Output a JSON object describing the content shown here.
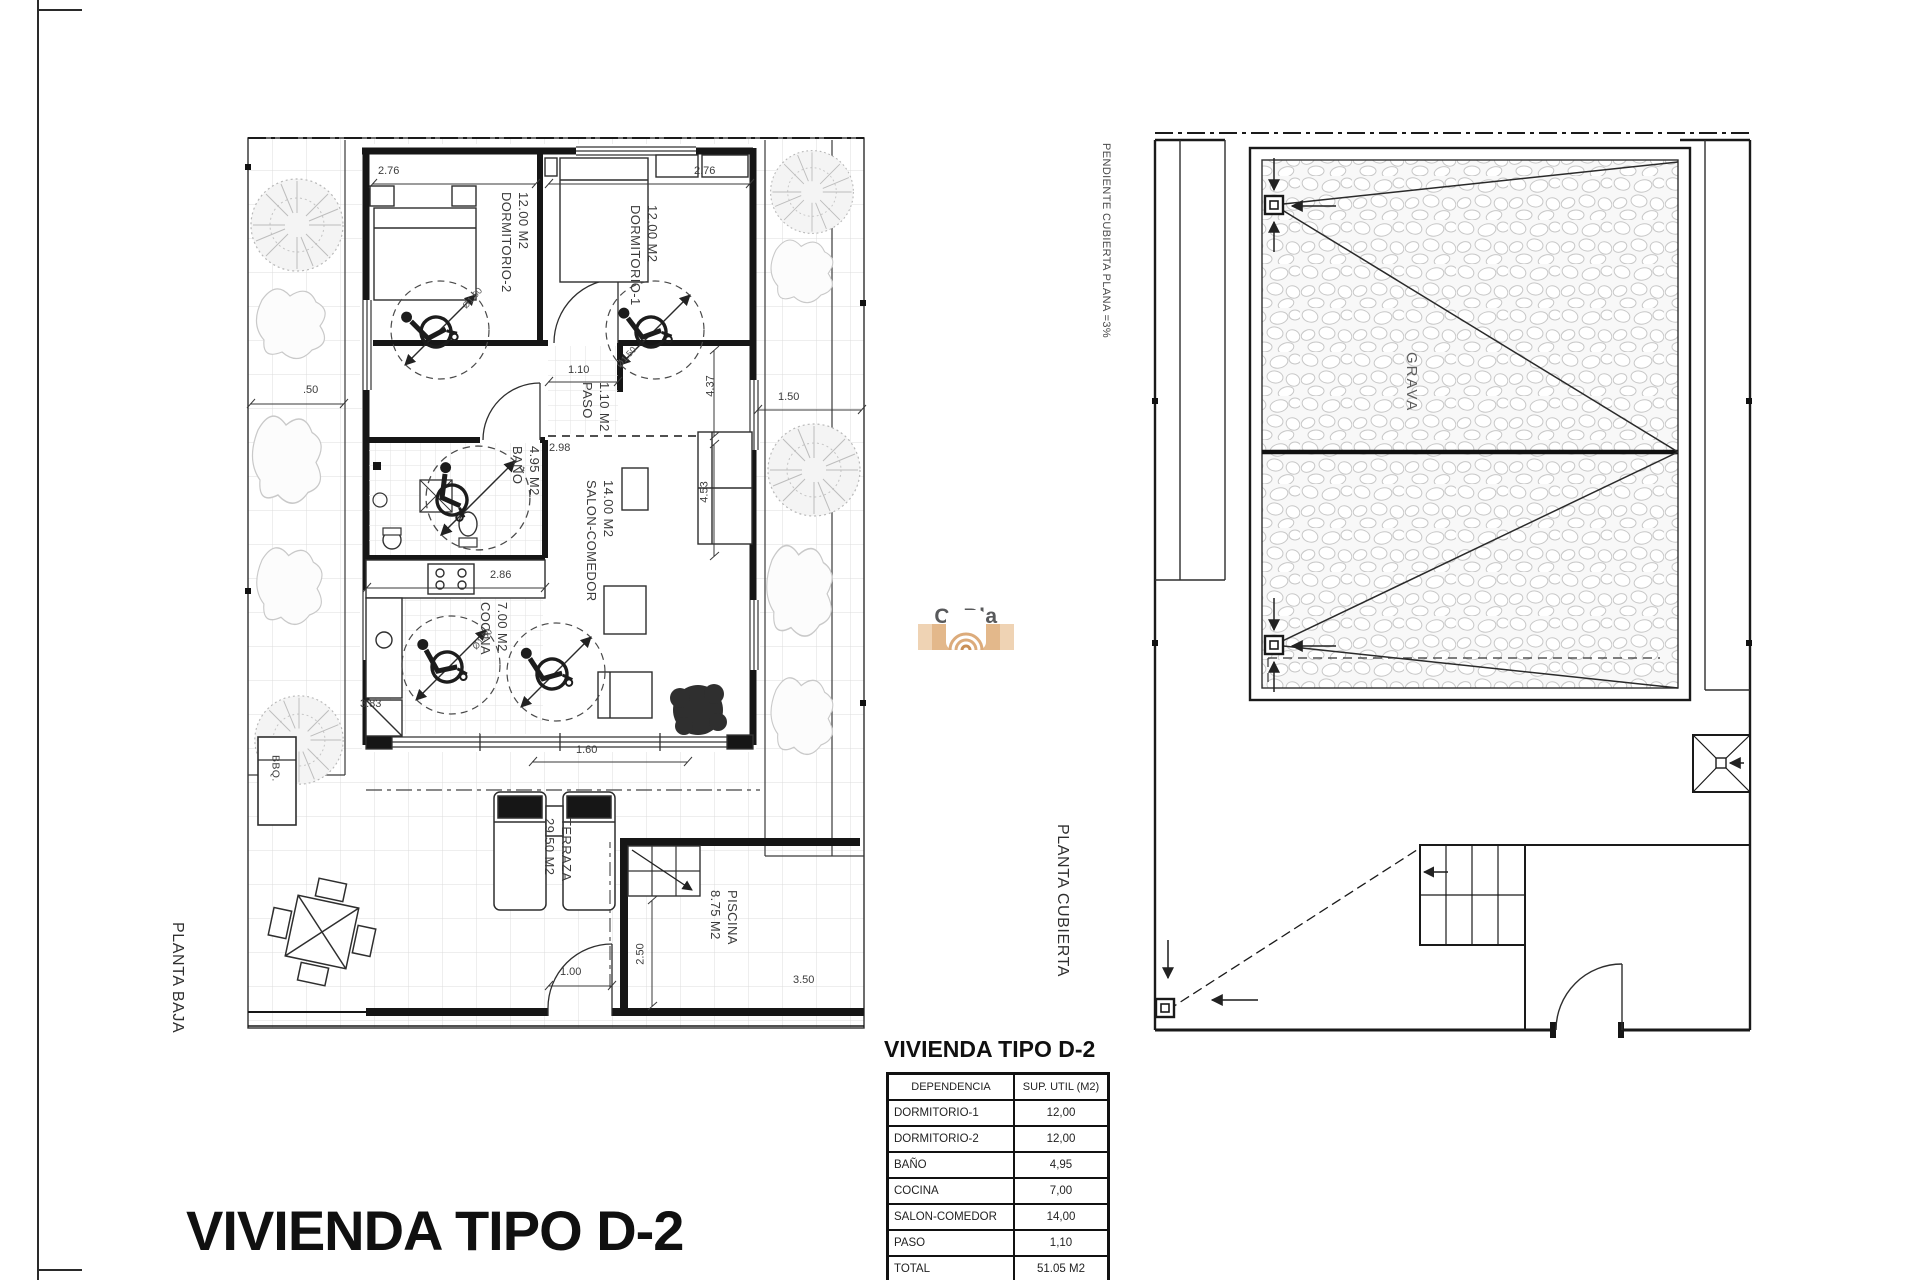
{
  "sheet": {
    "main_title": "VIVIENDA TIPO D-2",
    "ground_floor_label": "PLANTA BAJA",
    "roof_plan_label": "PLANTA CUBIERTA",
    "roof_slope_note": "PENDIENTE CUBIERTA PLANA =3%",
    "gravel_label": "GRAVA"
  },
  "logo": {
    "brand": "CoBla",
    "subtitle": "Vastgoed",
    "accent_color": "#dcab7b",
    "text_color": "#58595b"
  },
  "rooms": {
    "dormitorio2": {
      "name": "DORMITORIO-2",
      "area": "12.00 M2"
    },
    "dormitorio1": {
      "name": "DORMITORIO-1",
      "area": "12.00 M2"
    },
    "paso": {
      "name": "PASO",
      "area": "1.10 M2"
    },
    "bano": {
      "name": "BAÑO",
      "area": "4.95 M2"
    },
    "salon": {
      "name": "SALON-COMEDOR",
      "area": "14.00 M2"
    },
    "cocina": {
      "name": "COCINA",
      "area": "7.00 M2"
    },
    "terraza": {
      "name": "TERRAZA",
      "area": "29.50 M2"
    },
    "piscina": {
      "name": "PISCINA",
      "area": "8.75 M2"
    },
    "bbq": "BBQ."
  },
  "dimensions": {
    "dorm2_width": "2.76",
    "dorm1_width": "2.76",
    "paso_width": "1.10",
    "bano_width": "2.98",
    "cocina_width": "2.86",
    "salon_depth_a": "4.37",
    "salon_depth_b": "4.53",
    "left_strip": ".50",
    "right_strip": "1.50",
    "cocina_corner": "3.83",
    "glass_door": "1.60",
    "terrace_gate": "1.00",
    "pool_side": "2.50",
    "pool_width": "3.50",
    "turning_circle": "Ø1.50"
  },
  "summary_table": {
    "title": "VIVIENDA TIPO D-2",
    "col_headers": [
      "DEPENDENCIA",
      "SUP. UTIL (M2)"
    ],
    "rows": [
      {
        "room": "DORMITORIO-1",
        "value": "12,00"
      },
      {
        "room": "DORMITORIO-2",
        "value": "12,00"
      },
      {
        "room": "BAÑO",
        "value": "4,95"
      },
      {
        "room": "COCINA",
        "value": "7,00"
      },
      {
        "room": "SALON-COMEDOR",
        "value": "14,00"
      },
      {
        "room": "PASO",
        "value": "1,10"
      },
      {
        "room": "TOTAL",
        "value": "51.05 M2"
      }
    ]
  }
}
